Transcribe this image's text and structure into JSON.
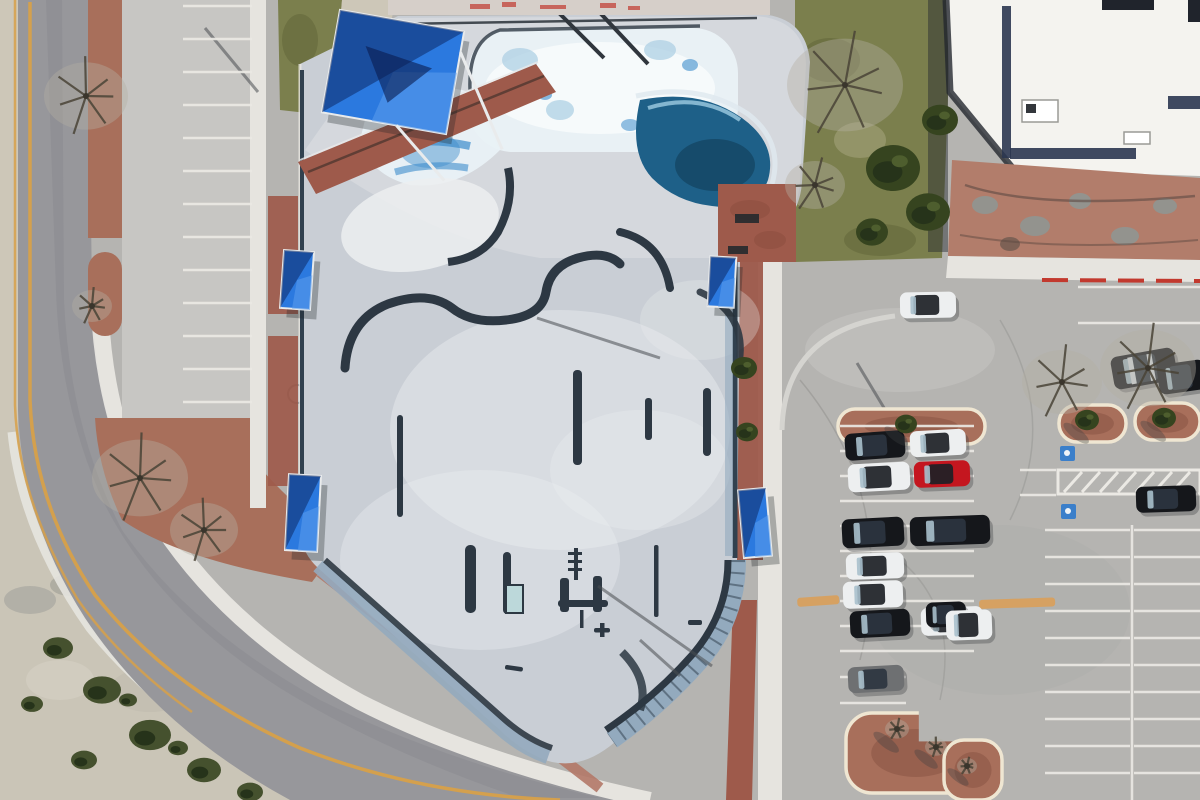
{
  "meta": {
    "title": "Aerial satellite photo — concrete skatepark beside a parking lot",
    "width_px": 1200,
    "height_px": 800
  },
  "scene": {
    "kind": "satellite-aerial-photo",
    "description": "Overhead satellite view: a concrete skatepark with ice-blue painted pool bowls, a deep blue kidney bowl, snake-run ledges, grind rails and five bright blue shade canopies, bordered by red brick paths; a curving road with yellow centerline at left, desert scrub at lower-left, a street-side parking strip, a large gray parking lot at right with planted islands, accessible-stall hatching and parked cars, and a white flat-roofed building with rock landscaping at top-right.",
    "palette": {
      "asphalt": "#97979b",
      "shoulderTan": "#cdc7b8",
      "yellowLine": "#d7a049",
      "sidewalk": "#e6e4df",
      "lineWhite": "#ebe9e4",
      "curbRed": "#c2392e",
      "dirtRed": "#a86f5b",
      "brick": "#9e5a4b",
      "brickLight": "#b27868",
      "parkConcrete": "#c9ced5",
      "parkLight": "#d8dbdf",
      "parkWhite": "#eceef0",
      "parkShadow": "#2d3843",
      "bankBlue": "#93aabe",
      "bankNavy": "#31414f",
      "poolIce": "#e9f1f5",
      "poolBlue": "#3c8ccc",
      "poolPale": "#a9cde2",
      "poolDeep": "#1e6088",
      "poolDeepDark": "#164b6b",
      "canopyBlue": "#2b79df",
      "canopyLight": "#5d9fec",
      "canopyNavy": "#0d2a66",
      "grass": "#7b7f4d",
      "grassDark": "#5f6438",
      "bushGreen": "#36441f",
      "treeBare": "#b4b0a2",
      "branch": "#4a4437",
      "buildingWhite": "#f4f3ef",
      "buildingTrim": "#2b3650",
      "buildingShadow": "#23272e",
      "rockRed": "#b27d6b",
      "boulder": "#93938e",
      "lotGray": "#b5b4b1",
      "lotLight": "#c7c6c3",
      "hcBlue": "#3b7fca",
      "speedBump": "#d8a05e",
      "carBlack": "#15171b",
      "carWhite": "#edeff0",
      "carRed": "#c4161f",
      "carGray": "#6e7072",
      "glass": "#a9c0cc",
      "shadow": "#3c4043",
      "scrub": "#cac5b7"
    },
    "counts": {
      "shade_canopies": 5,
      "parked_cars": 16,
      "moving_cars": 1,
      "planted_islands": 5,
      "accessible_stall_markings": 2,
      "speed_bumps": 2
    },
    "canopies": [
      {
        "cx": 393,
        "cy": 72,
        "w": 126,
        "h": 104,
        "angle": 10,
        "kind": "large"
      },
      {
        "cx": 297,
        "cy": 280,
        "w": 30,
        "h": 58,
        "angle": 4,
        "kind": "small"
      },
      {
        "cx": 303,
        "cy": 513,
        "w": 32,
        "h": 76,
        "angle": 3,
        "kind": "small"
      },
      {
        "cx": 722,
        "cy": 282,
        "w": 26,
        "h": 50,
        "angle": 3,
        "kind": "small"
      },
      {
        "cx": 755,
        "cy": 523,
        "w": 28,
        "h": 68,
        "angle": -5,
        "kind": "small"
      }
    ],
    "cars": [
      {
        "x": 845,
        "y": 432,
        "w": 60,
        "h": 27,
        "a": -4,
        "body": "carBlack"
      },
      {
        "x": 910,
        "y": 430,
        "w": 56,
        "h": 26,
        "a": -3,
        "body": "carWhite",
        "dark": true
      },
      {
        "x": 848,
        "y": 463,
        "w": 62,
        "h": 28,
        "a": -3,
        "body": "carWhite",
        "dark": true
      },
      {
        "x": 914,
        "y": 461,
        "w": 56,
        "h": 26,
        "a": -2,
        "body": "carRed",
        "dark": true
      },
      {
        "x": 842,
        "y": 518,
        "w": 62,
        "h": 29,
        "a": -3,
        "body": "carBlack"
      },
      {
        "x": 910,
        "y": 516,
        "w": 80,
        "h": 29,
        "a": -2,
        "body": "carBlack"
      },
      {
        "x": 846,
        "y": 553,
        "w": 58,
        "h": 26,
        "a": -2,
        "body": "carWhite",
        "dark": true
      },
      {
        "x": 843,
        "y": 581,
        "w": 60,
        "h": 27,
        "a": -2,
        "body": "carWhite",
        "dark": true
      },
      {
        "x": 850,
        "y": 610,
        "w": 60,
        "h": 27,
        "a": -3,
        "body": "carBlack"
      },
      {
        "x": 921,
        "y": 607,
        "w": 62,
        "h": 28,
        "a": -2,
        "body": "carWhite",
        "dark": true
      },
      {
        "x": 848,
        "y": 666,
        "w": 56,
        "h": 26,
        "a": -3,
        "body": "carGray"
      },
      {
        "x": 1112,
        "y": 352,
        "w": 64,
        "h": 33,
        "a": -10,
        "body": "carBlack",
        "stripes": true
      },
      {
        "x": 1158,
        "y": 362,
        "w": 48,
        "h": 30,
        "a": -8,
        "body": "carBlack"
      },
      {
        "x": 1136,
        "y": 486,
        "w": 60,
        "h": 26,
        "a": -2,
        "body": "carBlack"
      },
      {
        "x": 926,
        "y": 602,
        "w": 40,
        "h": 25,
        "a": -2,
        "body": "carBlack"
      },
      {
        "x": 946,
        "y": 610,
        "w": 46,
        "h": 30,
        "a": -2,
        "body": "carWhite",
        "dark": true
      },
      {
        "x": 900,
        "y": 292,
        "w": 56,
        "h": 26,
        "a": -1,
        "body": "carWhite",
        "dark": true,
        "moving": true
      }
    ],
    "islands": [
      {
        "x": 838,
        "y": 409,
        "w": 147,
        "h": 35,
        "rx": 17
      },
      {
        "x": 1059,
        "y": 405,
        "w": 67,
        "h": 37,
        "rx": 18
      },
      {
        "x": 1135,
        "y": 403,
        "w": 65,
        "h": 37,
        "rx": 18
      },
      {
        "x": 846,
        "y": 713,
        "w": 140,
        "h": 80,
        "rx": 26,
        "notch": true
      },
      {
        "x": 944,
        "y": 740,
        "w": 58,
        "h": 60,
        "rx": 20
      }
    ],
    "stall_line_groups": [
      {
        "x1": 183,
        "x2": 252,
        "y0": 6,
        "step": 33,
        "count": 13
      },
      {
        "x1": 840,
        "x2": 974,
        "y0": 426,
        "step": 25,
        "count": 10
      },
      {
        "x1": 840,
        "x2": 906,
        "y0": 677,
        "step": 26,
        "count": 2
      },
      {
        "x1": 1078,
        "x2": 1200,
        "y0": 287,
        "step": 36,
        "count": 2
      },
      {
        "x1": 1045,
        "x2": 1130,
        "y0": 530,
        "step": 27,
        "count": 10
      },
      {
        "x1": 1134,
        "x2": 1200,
        "y0": 530,
        "step": 27,
        "count": 10
      },
      {
        "x1": 1020,
        "x2": 1056,
        "y0": 470,
        "step": 25,
        "count": 2
      }
    ],
    "speed_bumps": [
      {
        "x": 797,
        "y": 598,
        "w": 42,
        "h": 9,
        "a": -4
      },
      {
        "x": 979,
        "y": 600,
        "w": 76,
        "h": 9,
        "a": -2
      }
    ],
    "pole_shadows": [
      {
        "x1": 537,
        "y1": 318,
        "x2": 660,
        "y2": 358
      },
      {
        "x1": 598,
        "y1": 586,
        "x2": 712,
        "y2": 666
      },
      {
        "x1": 857,
        "y1": 363,
        "x2": 907,
        "y2": 446
      },
      {
        "x1": 205,
        "y1": 28,
        "x2": 258,
        "y2": 92
      },
      {
        "x1": 640,
        "y1": 640,
        "x2": 680,
        "y2": 676
      }
    ],
    "trees": [
      {
        "x": 86,
        "y": 96,
        "r": 42,
        "type": "bare"
      },
      {
        "x": 92,
        "y": 306,
        "r": 20,
        "type": "bare"
      },
      {
        "x": 140,
        "y": 478,
        "r": 48,
        "type": "bare"
      },
      {
        "x": 204,
        "y": 530,
        "r": 34,
        "type": "bare"
      },
      {
        "x": 845,
        "y": 85,
        "r": 58,
        "type": "bare"
      },
      {
        "x": 815,
        "y": 185,
        "r": 30,
        "type": "bare"
      },
      {
        "x": 893,
        "y": 168,
        "r": 27,
        "type": "green"
      },
      {
        "x": 928,
        "y": 212,
        "r": 22,
        "type": "green"
      },
      {
        "x": 940,
        "y": 120,
        "r": 18,
        "type": "green"
      },
      {
        "x": 872,
        "y": 232,
        "r": 16,
        "type": "green"
      },
      {
        "x": 1062,
        "y": 382,
        "r": 40,
        "type": "bare"
      },
      {
        "x": 1148,
        "y": 368,
        "r": 48,
        "type": "bare"
      },
      {
        "x": 744,
        "y": 368,
        "r": 13,
        "type": "green"
      },
      {
        "x": 747,
        "y": 432,
        "r": 11,
        "type": "green"
      },
      {
        "x": 906,
        "y": 424,
        "r": 11,
        "type": "green",
        "shadow": true
      },
      {
        "x": 1087,
        "y": 420,
        "r": 12,
        "type": "green",
        "shadow": true
      },
      {
        "x": 1164,
        "y": 418,
        "r": 12,
        "type": "green",
        "shadow": true
      },
      {
        "x": 897,
        "y": 729,
        "r": 12,
        "type": "bare",
        "shadow": true
      },
      {
        "x": 936,
        "y": 747,
        "r": 11,
        "type": "bare",
        "shadow": true
      },
      {
        "x": 967,
        "y": 766,
        "r": 10,
        "type": "bare",
        "shadow": true
      }
    ],
    "bushes": [
      {
        "x": 58,
        "y": 648,
        "r": 15
      },
      {
        "x": 102,
        "y": 690,
        "r": 19
      },
      {
        "x": 150,
        "y": 735,
        "r": 21
      },
      {
        "x": 204,
        "y": 770,
        "r": 17
      },
      {
        "x": 250,
        "y": 792,
        "r": 13
      },
      {
        "x": 84,
        "y": 760,
        "r": 13
      },
      {
        "x": 32,
        "y": 704,
        "r": 11
      },
      {
        "x": 128,
        "y": 700,
        "r": 9
      },
      {
        "x": 178,
        "y": 748,
        "r": 10
      }
    ]
  }
}
